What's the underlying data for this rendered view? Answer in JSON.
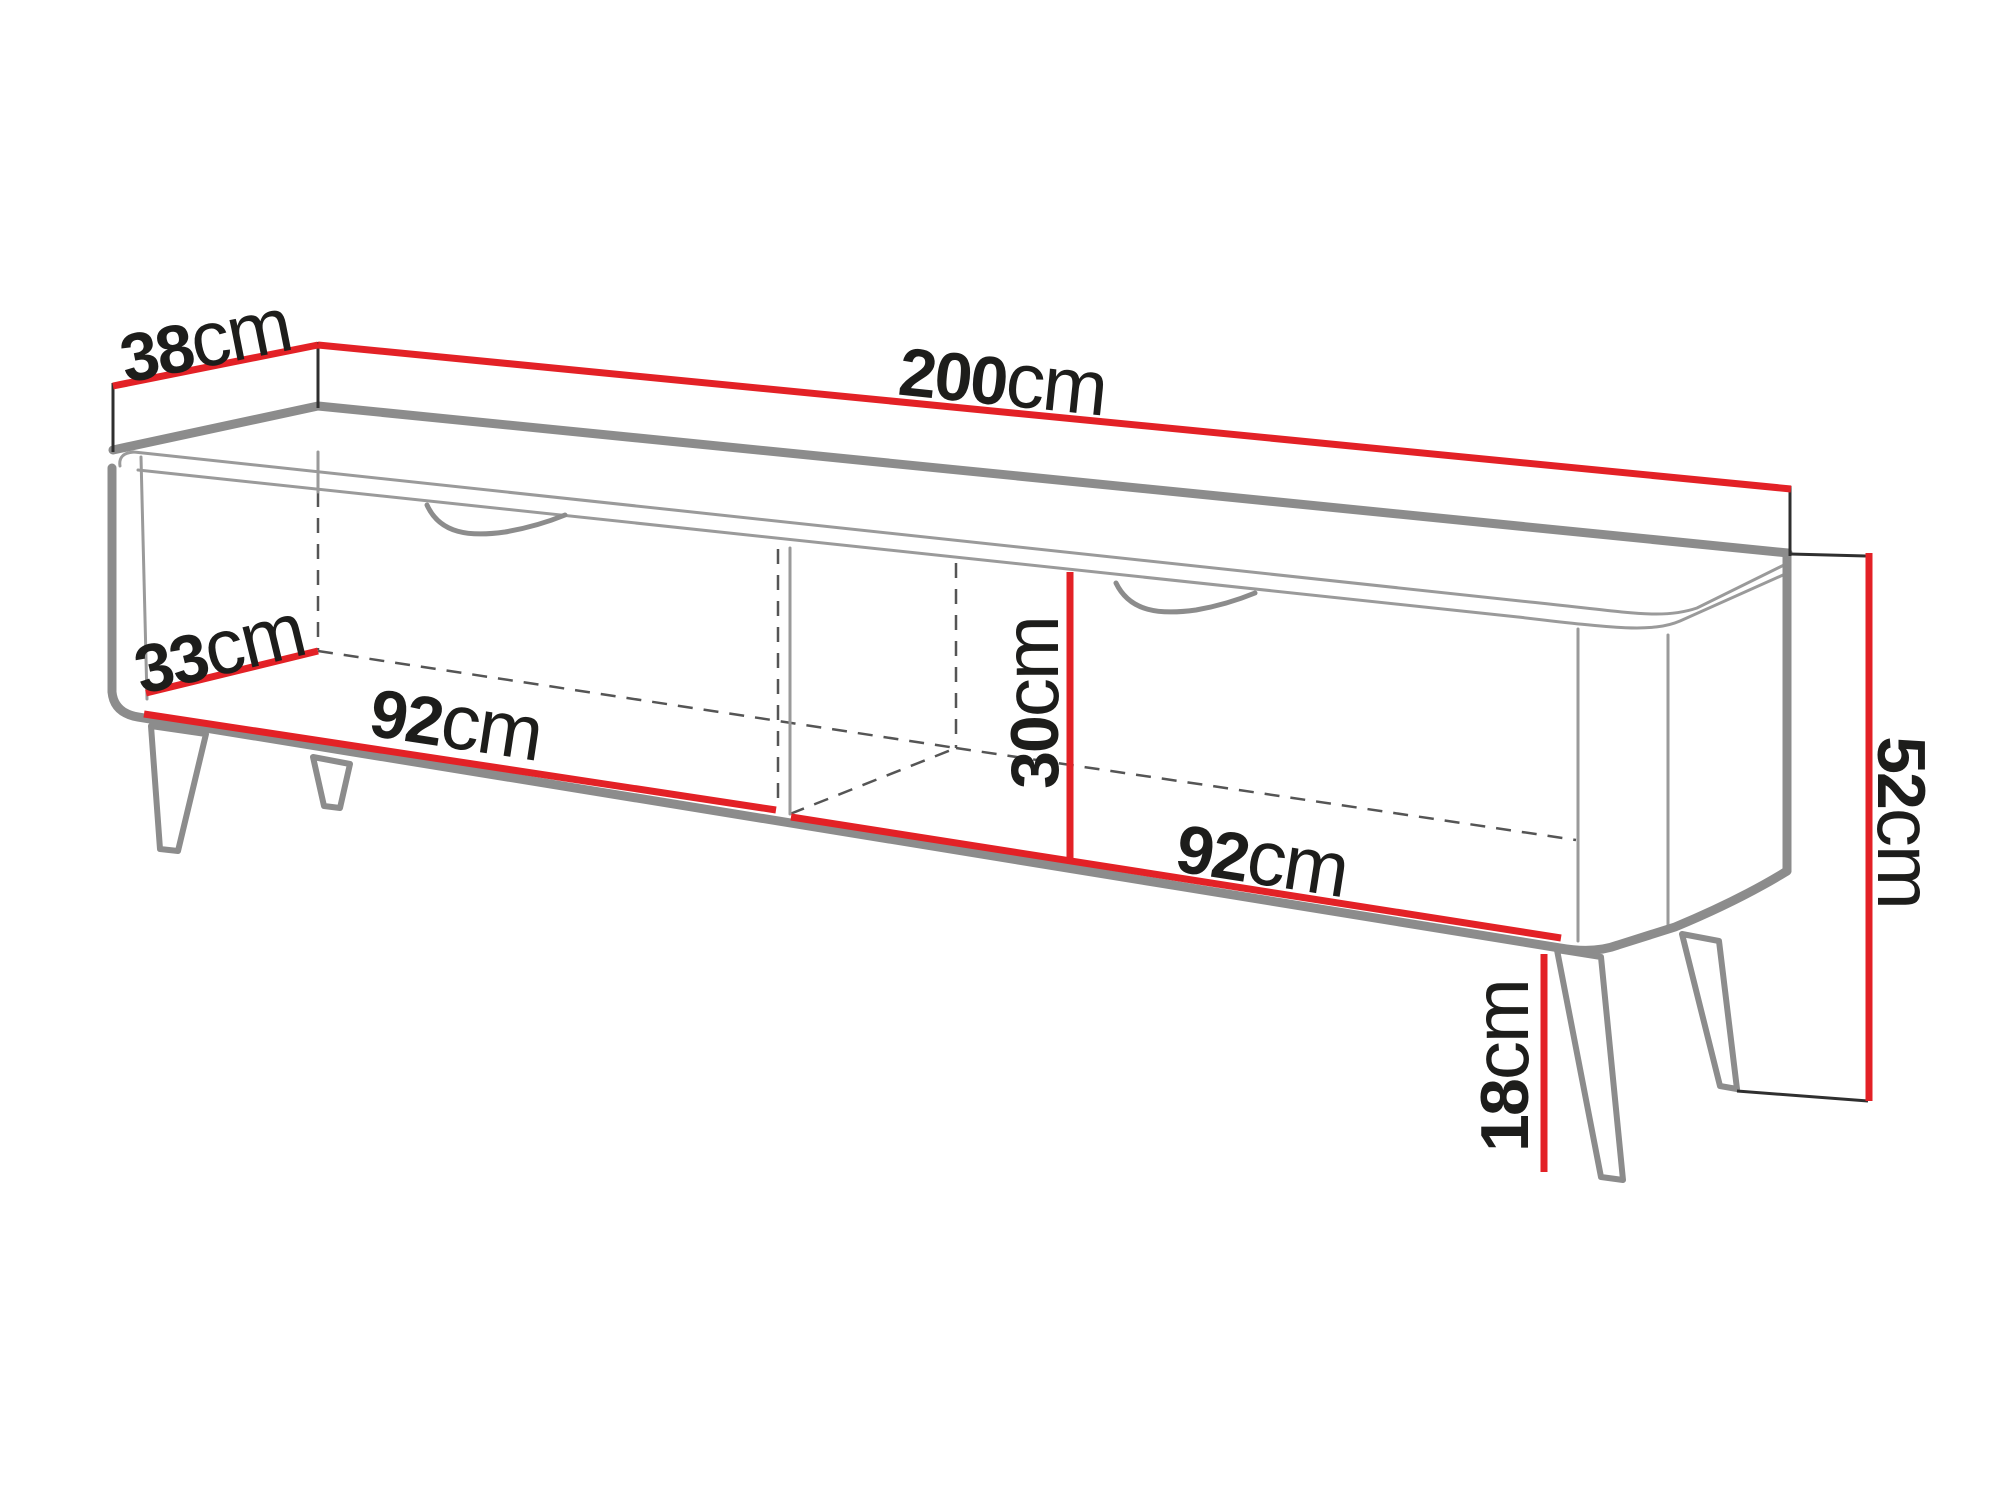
{
  "diagram": {
    "title": "TV cabinet dimension drawing",
    "type": "furniture-dimension-diagram",
    "background_color": "#ffffff",
    "colors": {
      "dimension_line": "#e32126",
      "outline_thick": "#8c8c8c",
      "outline_thin": "#9a9a9a",
      "hidden_edge_dash": "#555555",
      "extension_line": "#2f2f2f",
      "label_text": "#1d1d1b"
    },
    "dimensions": {
      "depth_top": {
        "value": "38",
        "unit": "cm",
        "meaning": "overall depth (top back edge)"
      },
      "width_total": {
        "value": "200",
        "unit": "cm",
        "meaning": "overall width (top back edge)"
      },
      "depth_interior": {
        "value": "33",
        "unit": "cm",
        "meaning": "interior niche depth"
      },
      "niche_left_width": {
        "value": "92",
        "unit": "cm",
        "meaning": "left compartment width (front bottom edge)"
      },
      "niche_height": {
        "value": "30",
        "unit": "cm",
        "meaning": "interior niche height"
      },
      "niche_right_width": {
        "value": "92",
        "unit": "cm",
        "meaning": "right compartment width (front bottom edge)"
      },
      "height_total": {
        "value": "52",
        "unit": "cm",
        "meaning": "overall height (right side)"
      },
      "legs_height": {
        "value": "18",
        "unit": "cm",
        "meaning": "leg height"
      }
    }
  }
}
